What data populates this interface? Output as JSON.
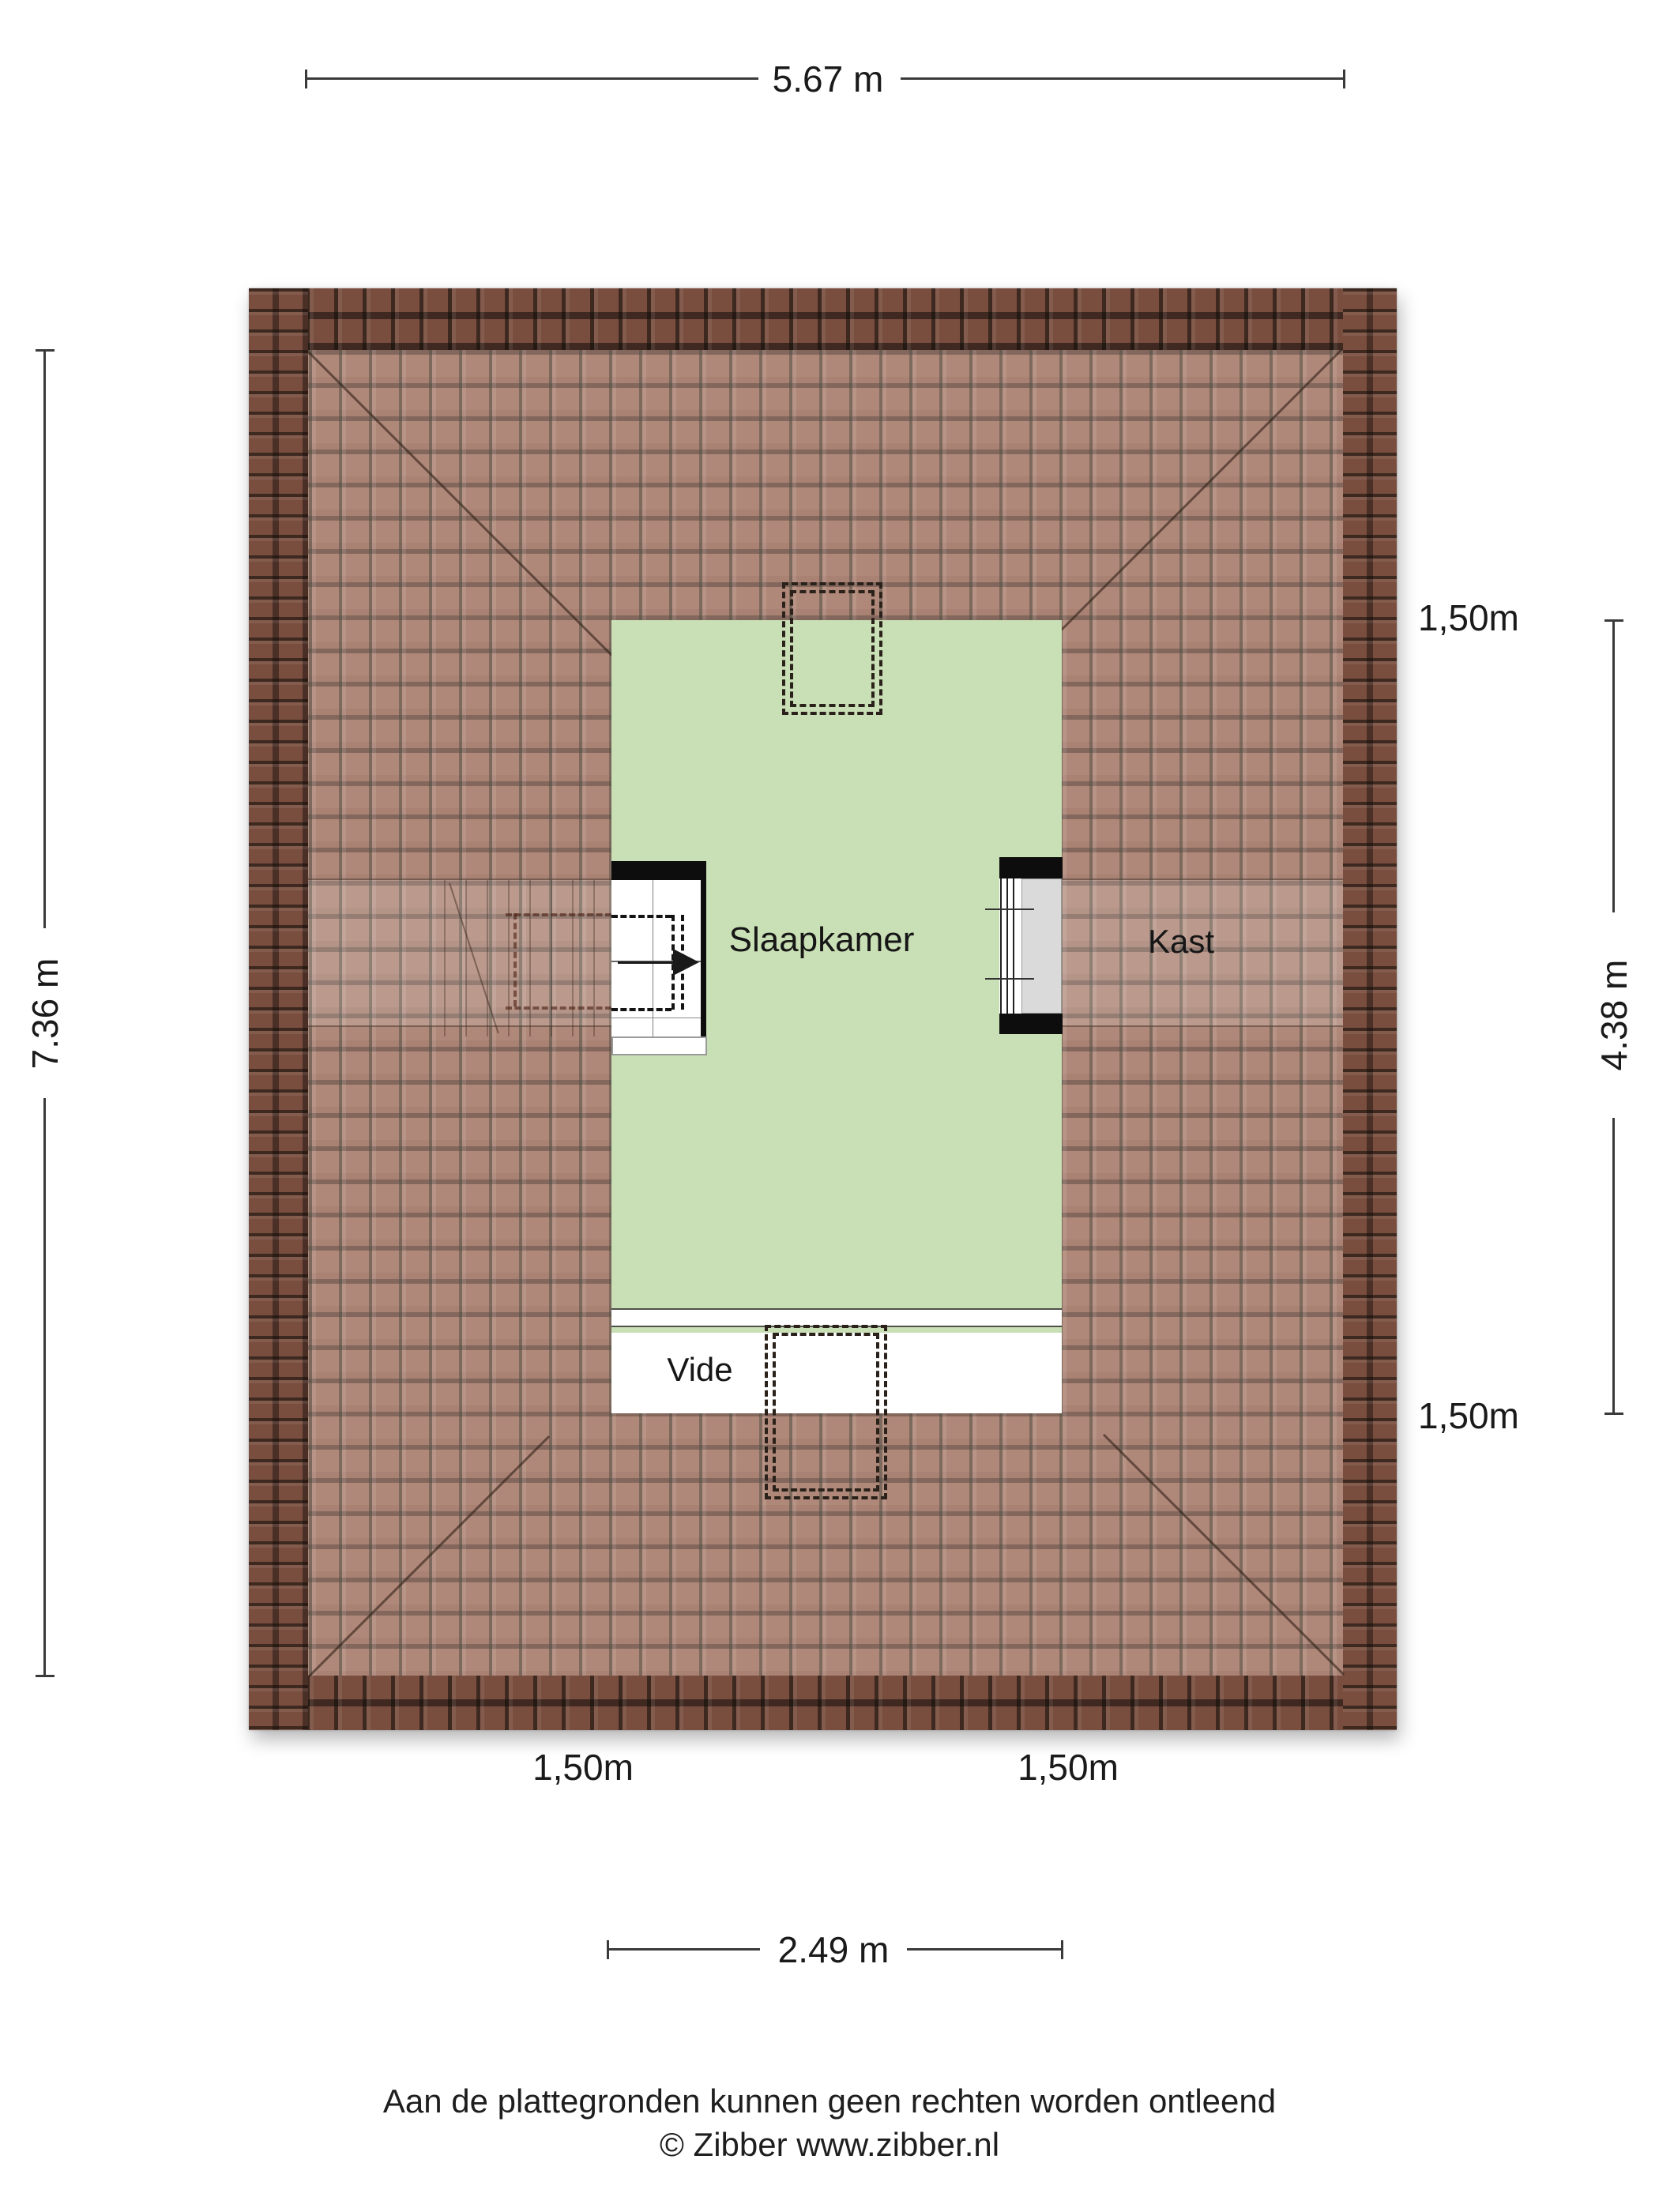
{
  "plan": {
    "rooms": [
      {
        "name": "Slaapkamer"
      },
      {
        "name": "Kast"
      },
      {
        "name": "Vide"
      }
    ],
    "dimensions": {
      "total_width": "5.67 m",
      "total_depth": "7.36 m",
      "room_depth": "4.38 m",
      "room_width": "2.49 m",
      "clearance_labels": [
        "1,50m",
        "1,50m",
        "1,50m",
        "1,50m"
      ]
    },
    "icons": [
      {
        "name": "stair-direction-arrow",
        "meaning": "stair walking direction"
      }
    ],
    "colors": {
      "room_fill": "#c9dfb5",
      "roof_tile": "#a1705e",
      "roof_eave": "#7a4e3f",
      "wall": "#0d0d0d",
      "dimension_text": "#1a1a1a"
    }
  },
  "footer": {
    "disclaimer": "Aan de plattegronden kunnen geen rechten worden ontleend",
    "credit": "© Zibber www.zibber.nl"
  }
}
